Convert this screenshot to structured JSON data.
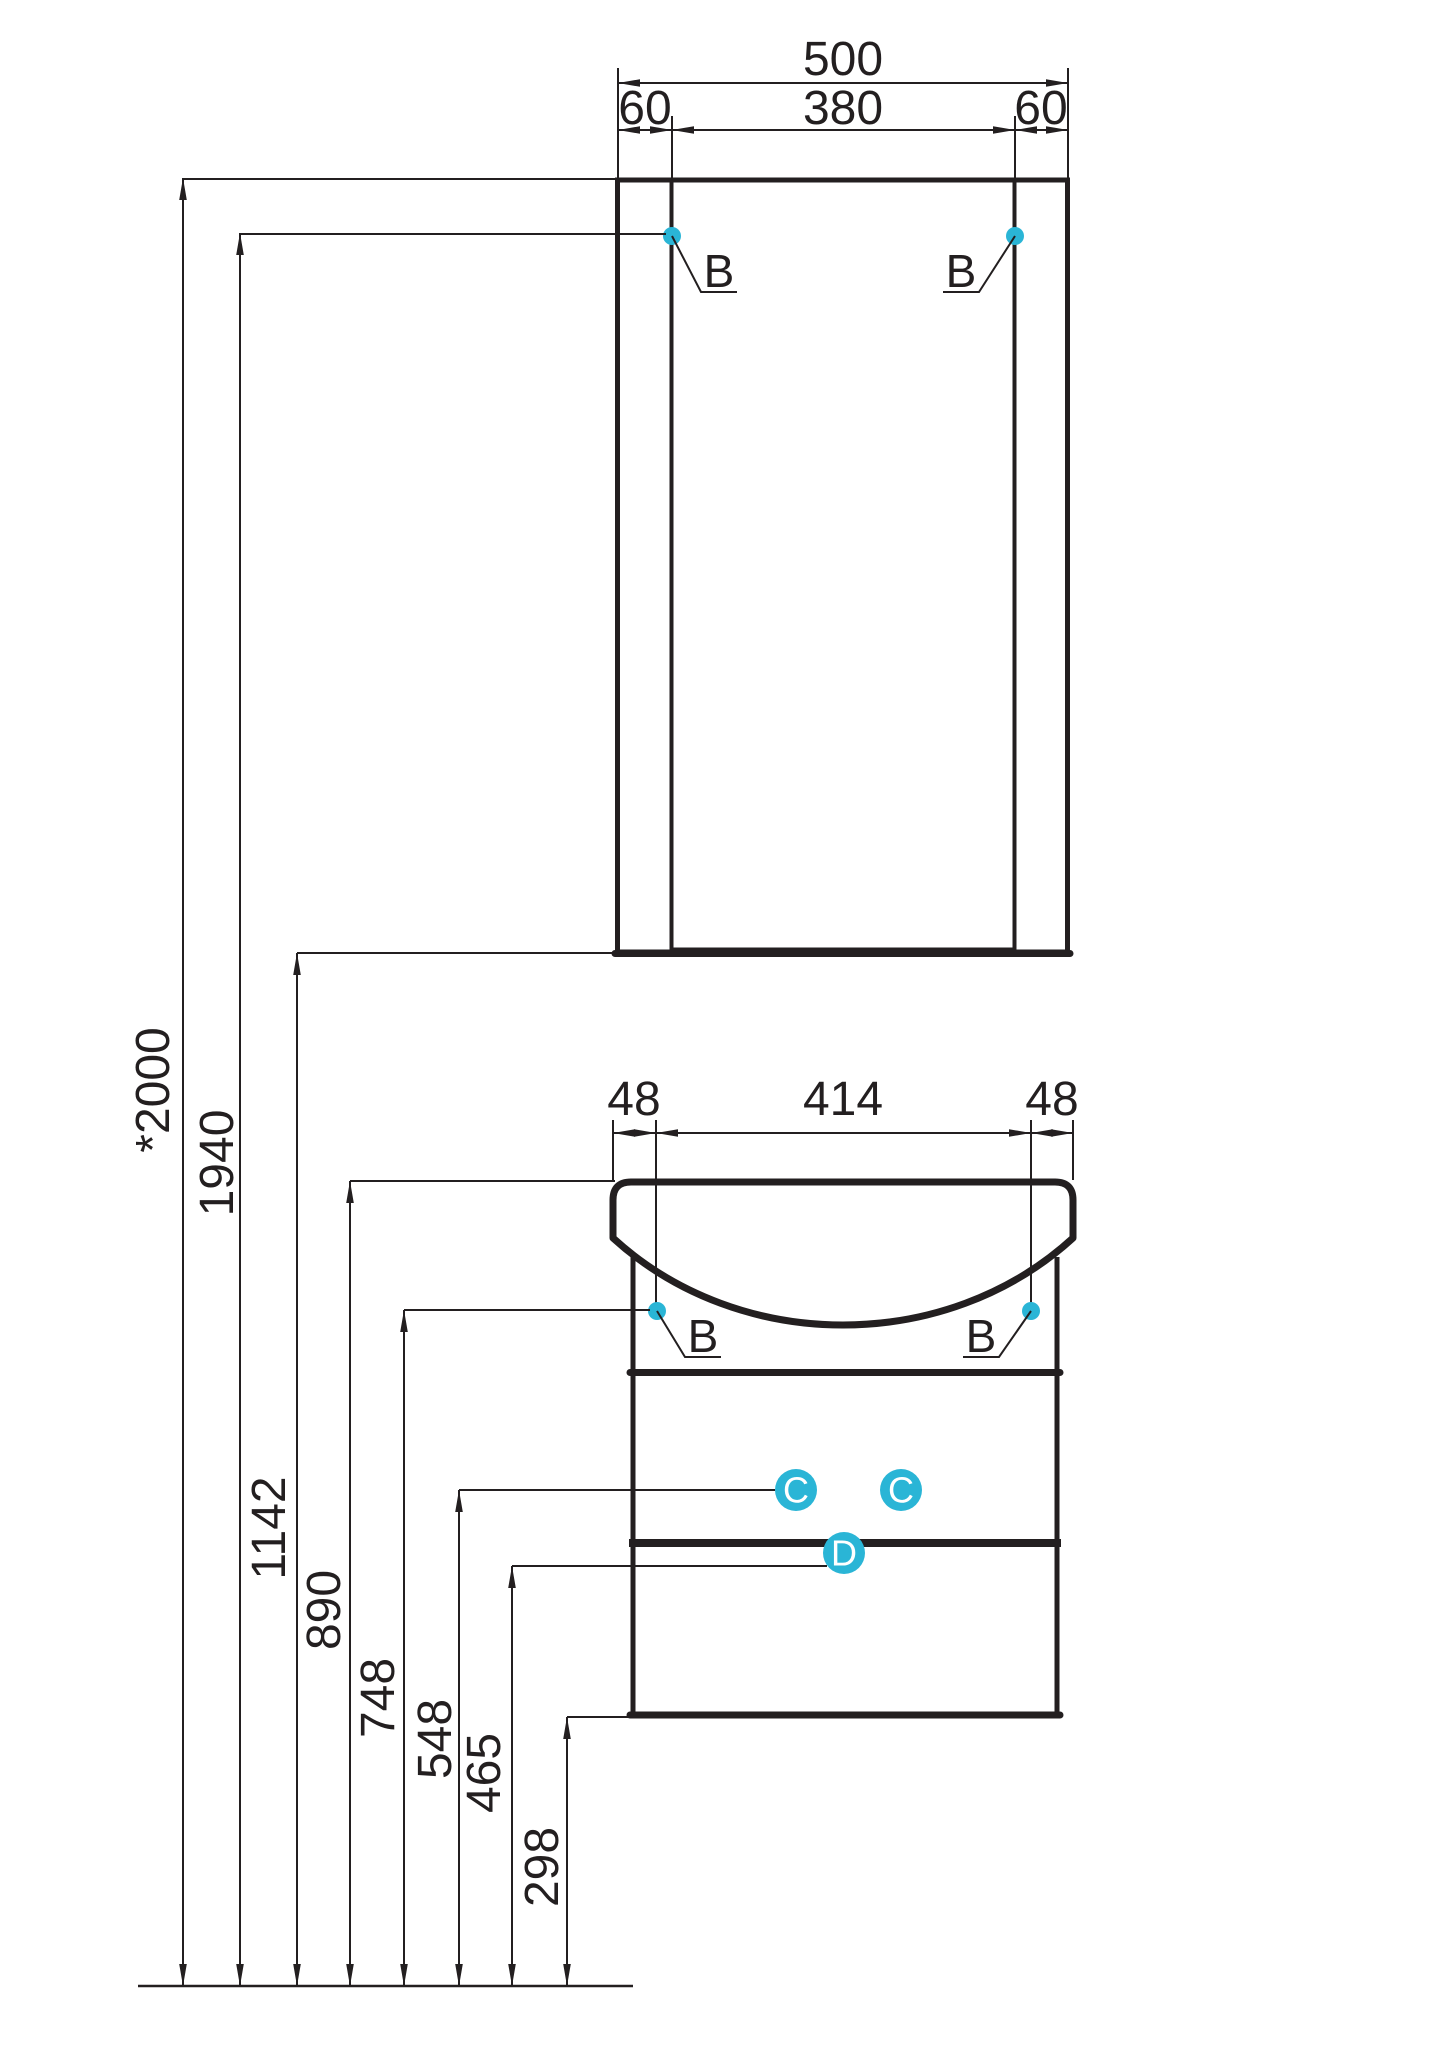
{
  "drawing": {
    "description": "Bathroom furniture installation dimension drawing: mirror cabinet above, washbasin vanity unit with two drawers below, wall-height dimension chain on the left",
    "colors": {
      "line": "#231f20",
      "accent": "#2ab5d6",
      "background": "#ffffff"
    },
    "dims": {
      "mirror": {
        "total": "500",
        "left": "60",
        "center": "380",
        "right": "60"
      },
      "sink": {
        "left": "48",
        "center": "414",
        "right": "48"
      },
      "heights": [
        "*2000",
        "1940",
        "1142",
        "890",
        "748",
        "548",
        "465",
        "298"
      ]
    },
    "callouts": {
      "b": "B",
      "c": "C",
      "d": "D"
    }
  }
}
